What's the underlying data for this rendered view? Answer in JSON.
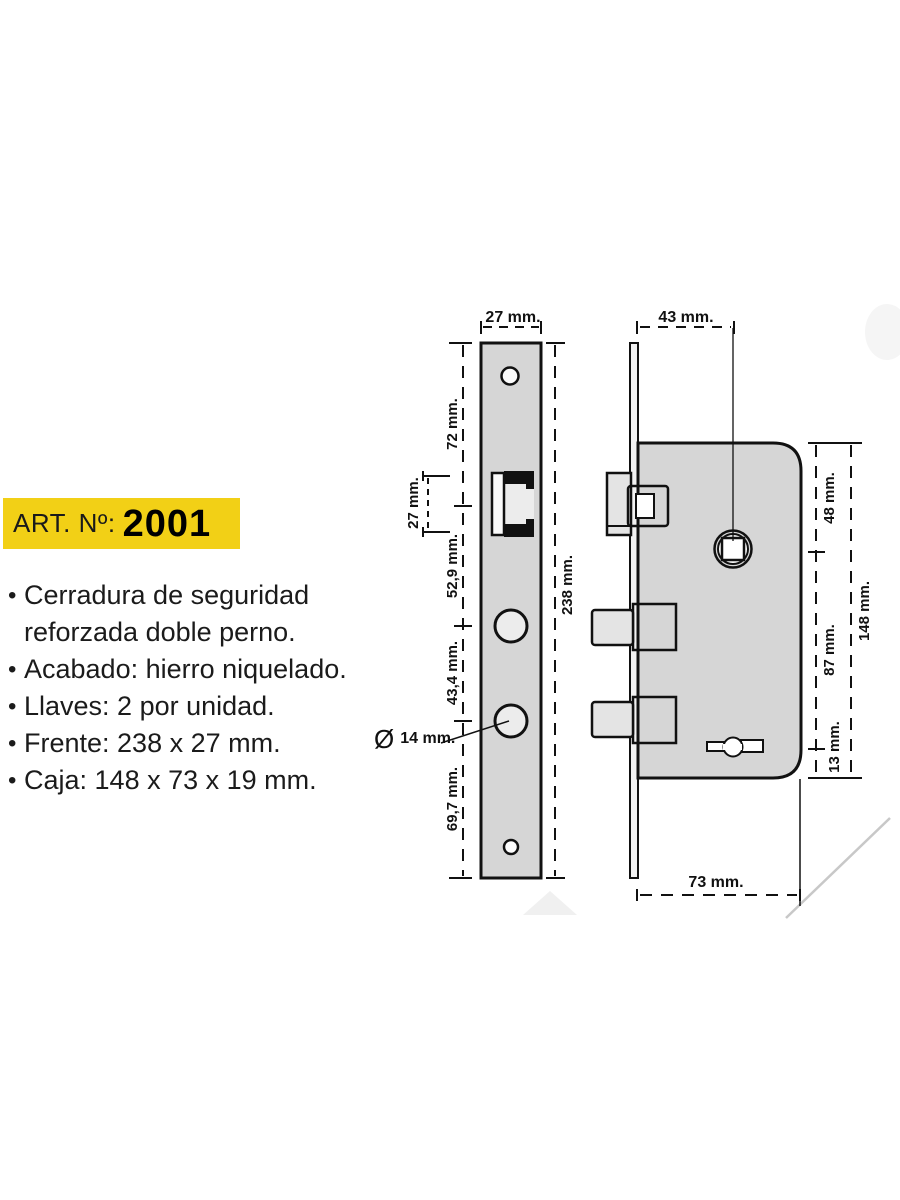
{
  "info": {
    "bullet": "•",
    "art_label": "ART. Nº:",
    "art_number": "2001",
    "features": [
      {
        "l1": "Cerradura de seguridad",
        "l2": "reforzada doble perno."
      },
      {
        "l1": "Acabado: hierro niquelado."
      },
      {
        "l1": "Llaves: 2 por unidad."
      },
      {
        "l1": "Frente: 238 x 27 mm."
      },
      {
        "l1": "Caja: 148 x 73 x 19 mm."
      }
    ]
  },
  "dims": {
    "front_width": "27 mm.",
    "top_to_latch": "72 mm.",
    "latch_height": "27 mm.",
    "latch_to_hole": "52,9 mm.",
    "hole_to_hole": "43,4 mm.",
    "hole_to_bottom": "69,7 mm.",
    "front_height": "238 mm.",
    "hole_diameter_symbol": "Ø",
    "hole_diameter": "14 mm.",
    "body_depth": "43 mm.",
    "top_to_spindle": "48 mm.",
    "spindle_to_keyhole": "87 mm.",
    "keyhole_to_bottom": "13 mm.",
    "body_height": "148 mm.",
    "body_width": "73 mm."
  },
  "colors": {
    "badge_yellow": "#f2d016",
    "metal_gray": "#d6d6d6",
    "bolt_gray": "#e4e4e4",
    "line_black": "#111111",
    "watermark_gray": "#c8c8c8"
  }
}
